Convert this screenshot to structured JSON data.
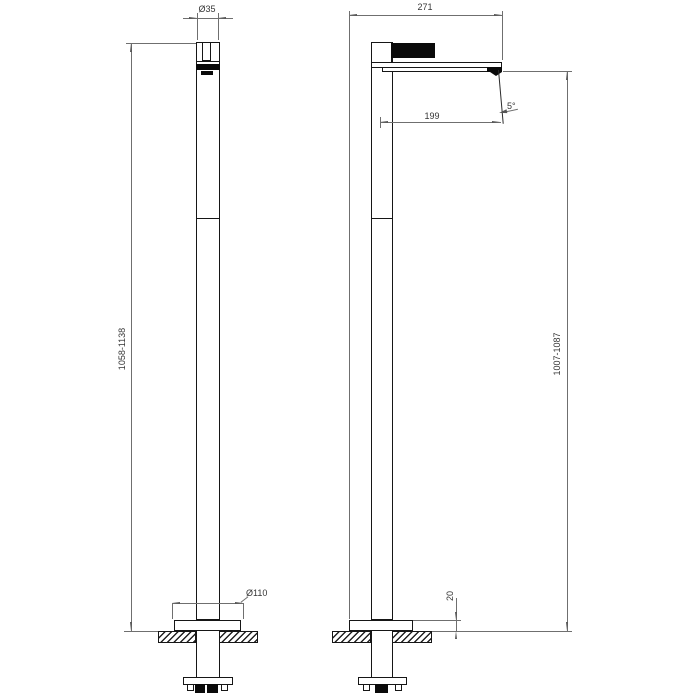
{
  "drawing": {
    "dimensions": {
      "handle_diameter": "Ø35",
      "total_depth": "271",
      "spout_reach": "199",
      "spout_angle": "5°",
      "height_range_left": "1058-1138",
      "height_range_right": "1007-1087",
      "base_plate_diameter": "Ø110",
      "base_plate_height": "20"
    }
  }
}
